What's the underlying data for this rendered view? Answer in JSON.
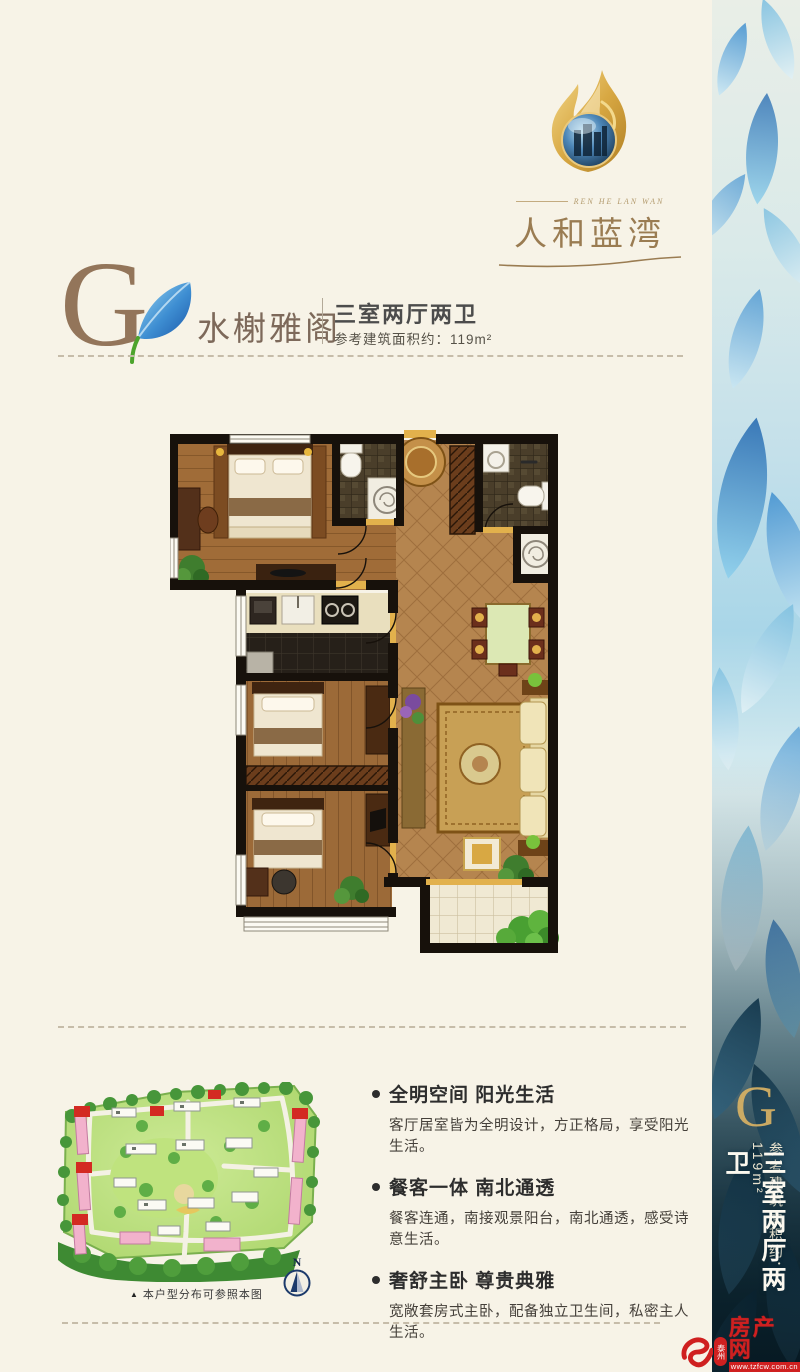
{
  "logo": {
    "en_tagline": "REN HE LAN WAN",
    "name": "人和蓝湾"
  },
  "header": {
    "letter": "G",
    "title": "水榭雅阁",
    "layout": "三室两厅两卫",
    "area": "参考建筑面积约：119m²"
  },
  "features": [
    {
      "title": "全明空间 阳光生活",
      "desc": "客厅居室皆为全明设计，方正格局，享受阳光生活。"
    },
    {
      "title": "餐客一体 南北通透",
      "desc": "餐客连通，南接观景阳台，南北通透，感受诗意生活。"
    },
    {
      "title": "奢舒主卧 尊贵典雅",
      "desc": "宽敞套房式主卧，配备独立卫生间，私密主人生活。"
    }
  ],
  "siteplan": {
    "caption_marker": "▲",
    "caption": "本户型分布可参照本图",
    "compass_label": "N"
  },
  "sidebar": {
    "letter": "G",
    "area": "参考建筑面积约：119m²",
    "layout": "三室两厅两卫"
  },
  "watermark": {
    "city_badge": "泰州",
    "site_name": "房产网",
    "url": "www.tzfcw.com.cn"
  },
  "colors": {
    "page_cream": "#f7f3e7",
    "brand_gold": "#9a7c52",
    "header_brown": "#93755a",
    "text_dark": "#2d2d2d",
    "petal_blue": "#3e8ed2",
    "watermark_red": "#cf2020",
    "plan_wall": "#17110b",
    "plan_wood": "#a06c38",
    "plan_hall_tile": "#b5854f"
  }
}
